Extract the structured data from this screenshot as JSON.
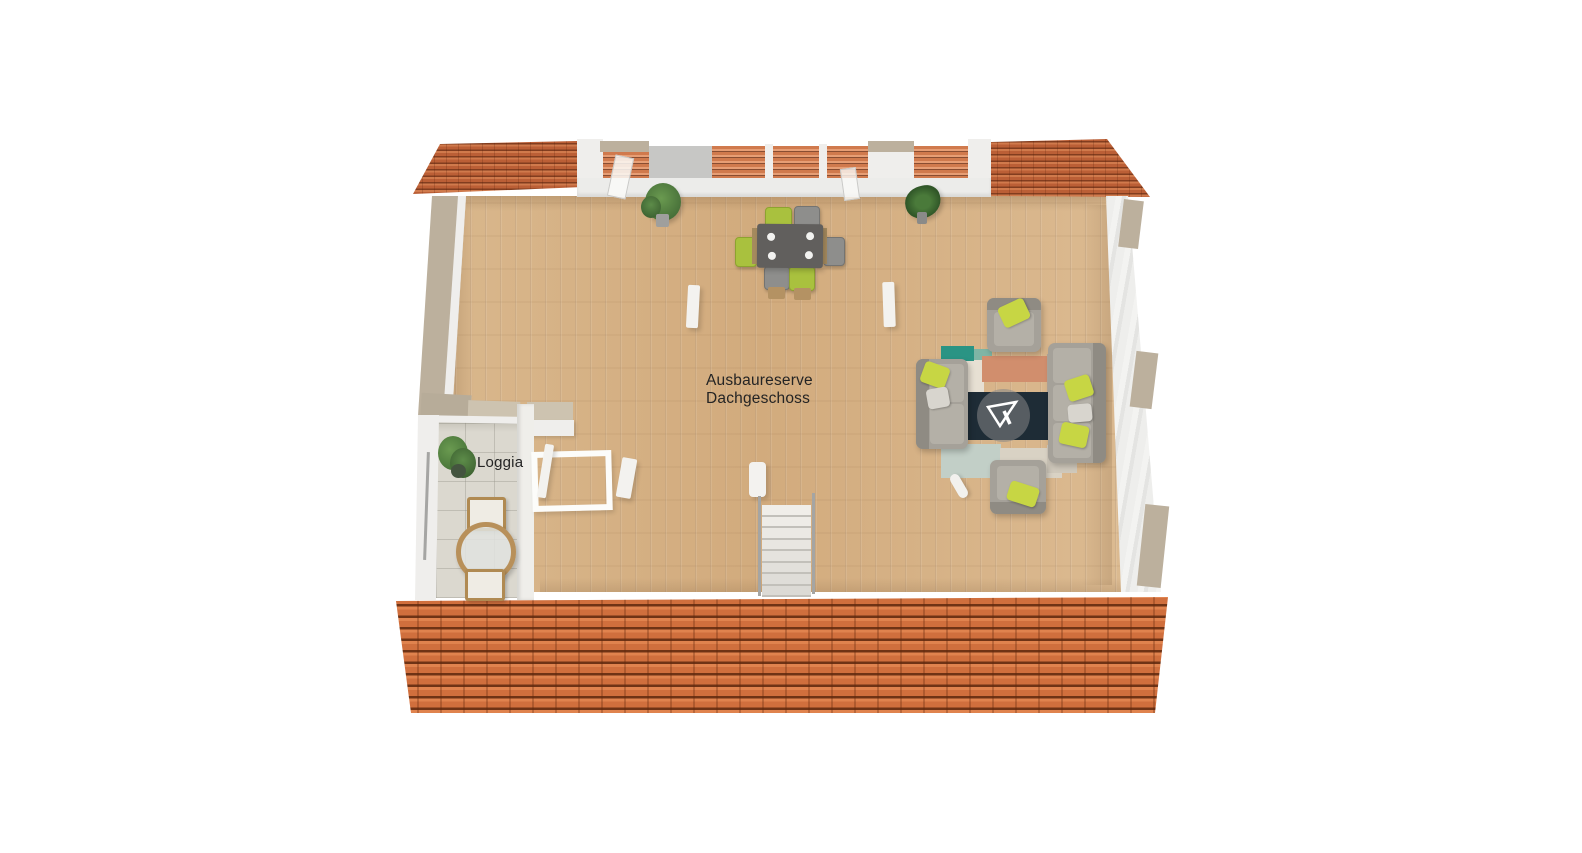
{
  "labels": {
    "main_room": {
      "line1": "Ausbaureserve",
      "line2": "Dachgeschoss"
    },
    "loggia": "Loggia"
  },
  "rooms": [
    {
      "name": "Ausbaureserve Dachgeschoss",
      "floor_material": "light oak parquet"
    },
    {
      "name": "Loggia",
      "floor_material": "light stone tiles"
    }
  ],
  "furniture": [
    "dining-table",
    "dining-chair-green x3",
    "dining-chair-gray x3",
    "sofa-2-seat",
    "sofa-3-seat",
    "armchair x2",
    "area-rug-patchwork",
    "staircase",
    "roof-window-skylight",
    "potted-plant x3",
    "loggia-round-table",
    "loggia-chair x2"
  ],
  "colors": {
    "background": "#ffffff",
    "wood_floor": "#d6b286",
    "loggia_tiles": "#dbd8cf",
    "roof_small": "#bb5f36",
    "roof_big": "#d06f3d",
    "wall_white": "#efeeec",
    "wall_beige": "#bcb09d",
    "accent_lime": "#c7d644",
    "sofa_gray": "#a5a199",
    "table_dark": "#615f5d",
    "rug_teal": "#2a9484",
    "rug_salmon": "#d18e6d",
    "rug_navy": "#1e2c36",
    "label_text": "#242424"
  }
}
